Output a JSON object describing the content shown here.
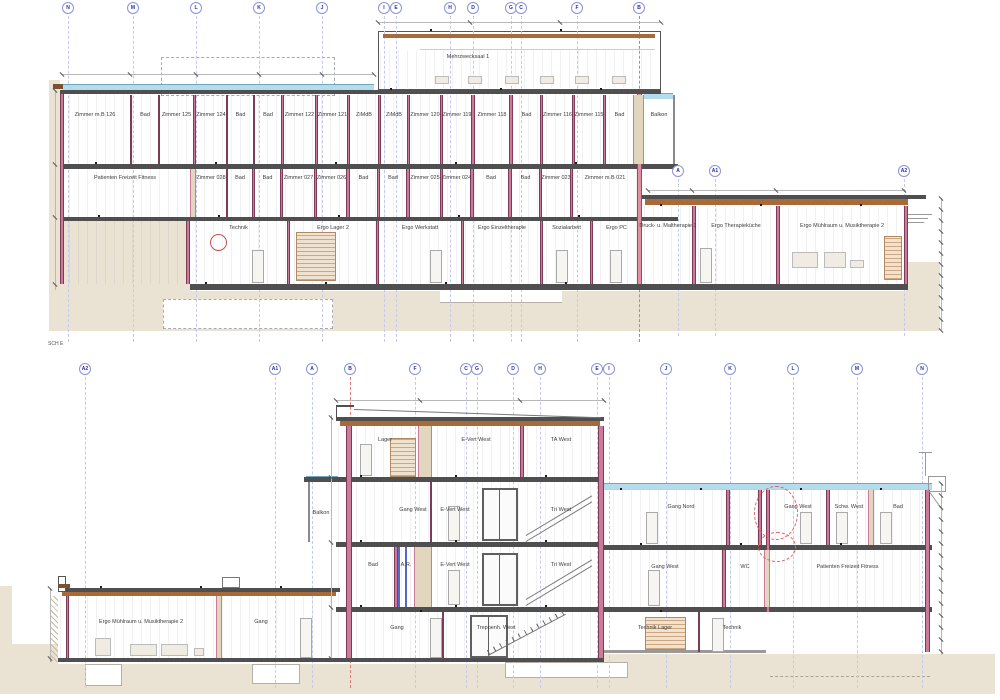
{
  "drawing": {
    "section_label": "SCH E",
    "colors": {
      "earth": "#EAE2D3",
      "grid-line": "#C3C9EF",
      "grid-red": "#E07878",
      "bubble-text": "#2929A8",
      "wall-pink": "#C97B99",
      "glass-blue": "#B4DCEC",
      "roof-tan": "#A96A3A",
      "slab-gray": "#4F4F4F"
    }
  },
  "upper_section": {
    "grid_bubbles": [
      "N",
      "M",
      "L",
      "K",
      "J",
      "I",
      "E",
      "H",
      "D",
      "G",
      "C",
      "F",
      "B"
    ],
    "wing_bubbles": [
      "A",
      "A1",
      "A2"
    ],
    "penthouse_label": "Mehrzwecksaal 1",
    "floor2_rooms": [
      "Zimmer m.B 126",
      "Bad",
      "Zimmer 125",
      "Zimmer 124",
      "Bad",
      "Bad",
      "Zimmer 122",
      "Zimmer 121",
      "ZiMdB",
      "ZiMdB",
      "Zimmer 120",
      "Zimmer 119",
      "Zimmer 118",
      "Bad",
      "Zimmer 116",
      "Zimmer 115",
      "Bad",
      "Balkon"
    ],
    "floor1_rooms": [
      "Patienten Freizeit Fitness",
      "Zimmer 028",
      "Bad",
      "Bad",
      "Zimmer 027",
      "Zimmer 026",
      "Bad",
      "Bad",
      "Zimmer 025",
      "Zimmer 024",
      "Bad",
      "Bad",
      "Zimmer 023",
      "Zimmer m.B 021"
    ],
    "ground_rooms": [
      "Technik",
      "Ergo Lager 2",
      "Ergo Werkstatt",
      "Ergo Einzeltherapie",
      "Sozialarbeit",
      "Ergo PC"
    ],
    "wing_rooms": [
      "Druck- u. Maltherapie 1",
      "Ergo Therapieküche",
      "Ergo Mühlraum u. Musiktherapie 2"
    ]
  },
  "lower_section": {
    "grid_bubbles": [
      "A2",
      "A1",
      "A",
      "B",
      "F",
      "C",
      "G",
      "D",
      "H",
      "E",
      "I",
      "J",
      "K",
      "L",
      "M",
      "N"
    ],
    "tower": {
      "floor3_rooms": [
        "Lager",
        "E-Vert West",
        "TA West"
      ],
      "floor2_rooms": [
        "Balkon",
        "Gang West",
        "E-Vert West",
        "Tri West"
      ],
      "floor1_rooms": [
        "Bad",
        "A.R.",
        "E-Vert West",
        "Tri West"
      ],
      "floor0_rooms": [
        "Gang",
        "Treppenh. West"
      ]
    },
    "right_wing": {
      "floor2_rooms": [
        "Gang Nord",
        "Gang West",
        "Schw. West",
        "Bad"
      ],
      "floor1_rooms": [
        "Gang West",
        "WC",
        "Patienten Freizeit Fitness"
      ],
      "floor0_rooms": [
        "Technik Lager",
        "Technik"
      ]
    },
    "left_wing_rooms": [
      "Ergo Mühlraum u. Musiktherapie 2",
      "Gang"
    ]
  }
}
